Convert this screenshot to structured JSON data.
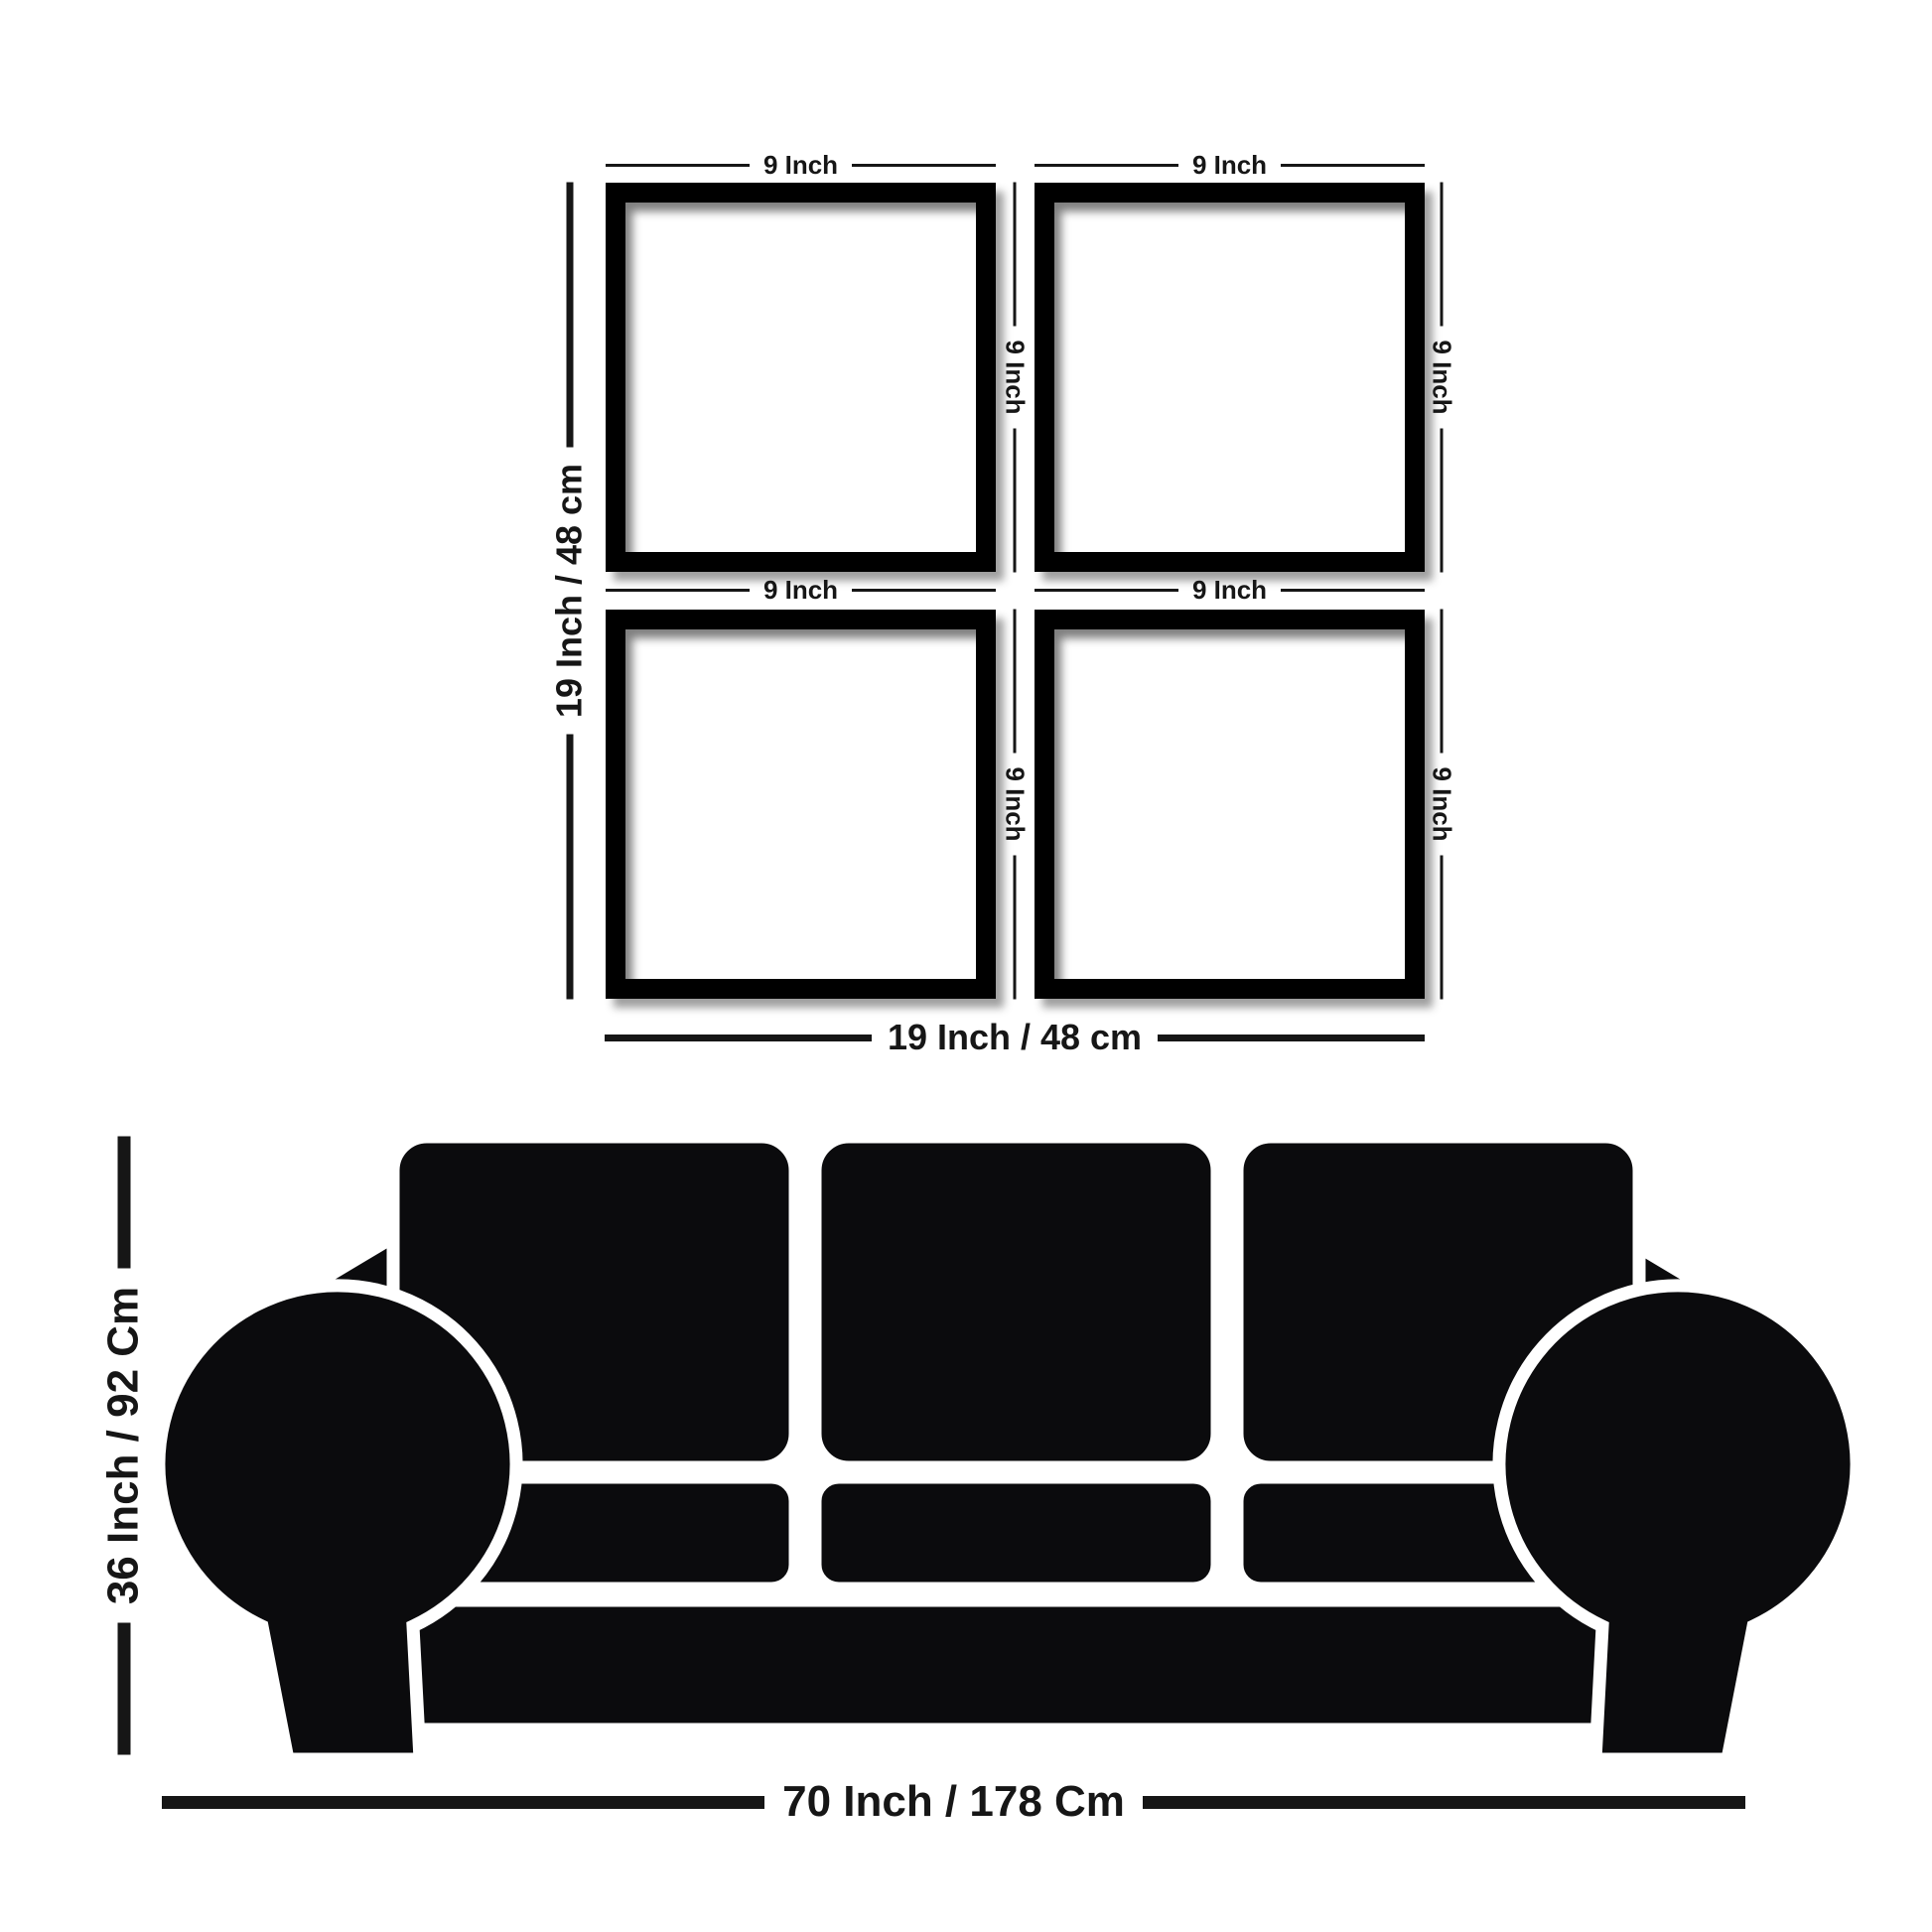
{
  "frames_panel": {
    "frame_width_labels": [
      "9 Inch",
      "9 Inch",
      "9 Inch",
      "9 Inch"
    ],
    "frame_height_labels": [
      "9 Inch",
      "9 Inch",
      "9 Inch",
      "9 Inch"
    ],
    "overall_height_label": "19 Inch / 48 cm",
    "overall_width_label": "19 Inch / 48 cm"
  },
  "sofa_panel": {
    "height_label": "36 Inch / 92 Cm",
    "width_label": "70 Inch / 178 Cm"
  },
  "colors": {
    "background": "#ffffff",
    "frame": "#000000",
    "sofa": "#0b0b0d",
    "dimension_text": "#161616",
    "dimension_line": "#161616"
  }
}
